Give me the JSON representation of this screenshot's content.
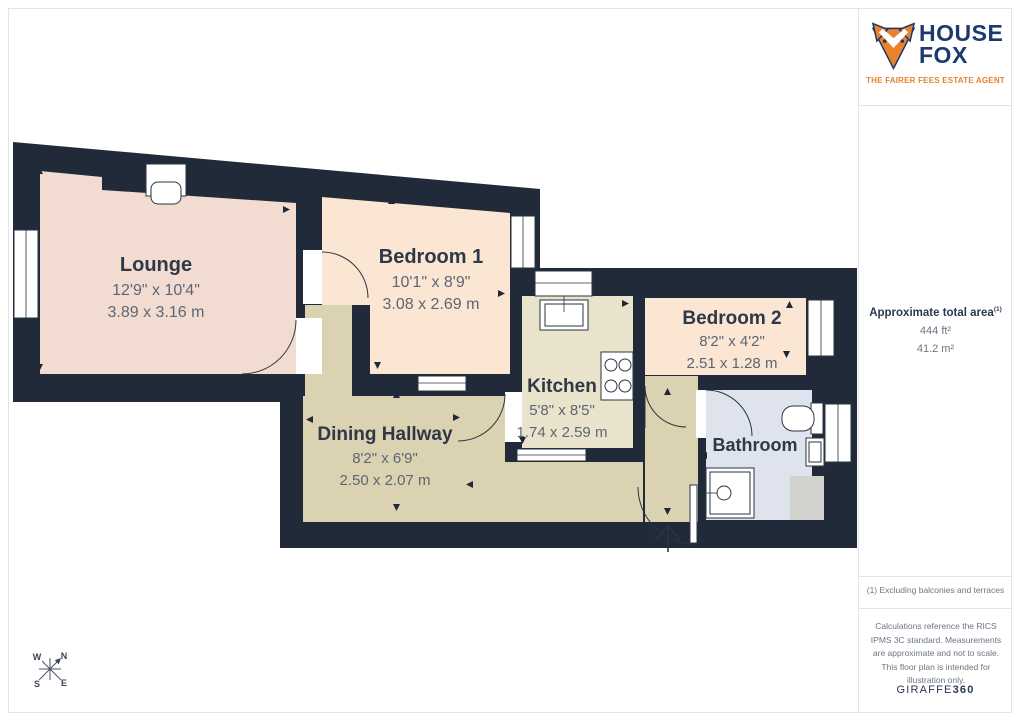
{
  "branding": {
    "name_top": "HOUSE",
    "name_bottom": "FOX",
    "tagline": "THE FAIRER FEES ESTATE AGENT"
  },
  "area_summary": {
    "title": "Approximate total area",
    "title_note": "(1)",
    "imperial": "444 ft²",
    "metric": "41.2 m²"
  },
  "notes": {
    "footnote": "(1) Excluding balconies and terraces",
    "disclaimer": "Calculations reference the RICS IPMS 3C standard. Measurements are approximate and not to scale. This floor plan is intended for illustration only.",
    "provider_prefix": "GIRAFFE",
    "provider_suffix": "360"
  },
  "rooms": {
    "lounge": {
      "name": "Lounge",
      "imperial": "12'9\" x 10'4\"",
      "metric": "3.89 x 3.16 m"
    },
    "bedroom1": {
      "name": "Bedroom 1",
      "imperial": "10'1\" x 8'9\"",
      "metric": "3.08 x 2.69 m"
    },
    "bedroom2": {
      "name": "Bedroom 2",
      "imperial": "8'2\" x 4'2\"",
      "metric": "2.51 x 1.28 m"
    },
    "kitchen": {
      "name": "Kitchen",
      "imperial": "5'8\" x 8'5\"",
      "metric": "1.74 x 2.59 m"
    },
    "dining_hallway": {
      "name": "Dining Hallway",
      "imperial": "8'2\" x 6'9\"",
      "metric": "2.50 x 2.07 m"
    },
    "bathroom": {
      "name": "Bathroom"
    }
  },
  "compass": {
    "n": "N",
    "e": "E",
    "s": "S",
    "w": "W"
  },
  "colors": {
    "wall": "#212a38",
    "lounge": "#f2dcd1",
    "bedroom": "#fbe5d3",
    "kitchen": "#eae3cb",
    "hallway": "#dbd2b1",
    "bathroom": "#dfe3ed",
    "terrace": "#d2d2cf",
    "brand_navy": "#1c3a6e",
    "brand_orange": "#e8822c"
  }
}
